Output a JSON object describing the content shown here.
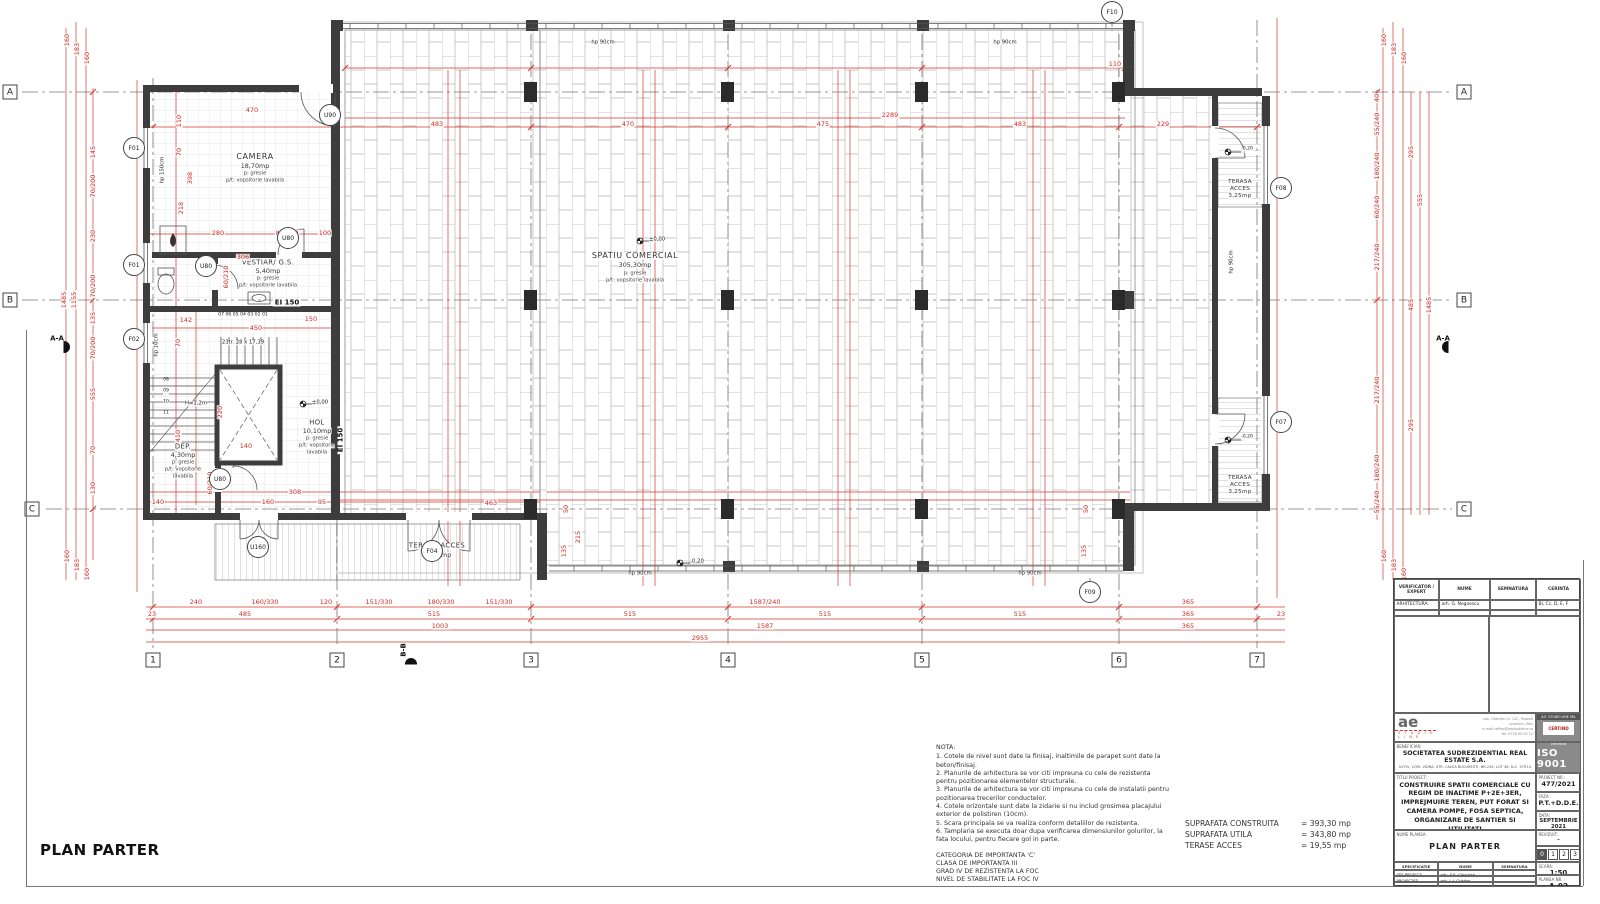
{
  "plan_title": "PLAN PARTER",
  "colors": {
    "dimension_red": "#cf2b24",
    "wall_dark": "#3d3d3d",
    "badge_gray": "#8a8a8a"
  },
  "notes": {
    "title": "NOTA:",
    "lines": [
      "1. Cotele de nivel sunt date la finisaj, inaltimile de parapet sunt date la beton/finisaj.",
      "2. Planurile de arhitectura se vor citi impreuna c​u cele de rezistenta pentru pozitionarea elementelor structurale.",
      "3. Planurile de arhitectura se vor citi impreuna cu cele de instalatii pentru pozitionarea trecerilor conductelor.",
      "4. Cotele orizontale sunt date la zidarie si nu includ grosimea placajului exterior de polistiren (10cm).",
      "5. Scara principala se va realiza conform detaliilor de rezistenta.",
      "6. Tamplaria se executa doar dupa verificarea dimensiunilor golurilor, la fata locului, pentru fiecare gol in parte."
    ],
    "importance": [
      "CATEGORIA DE IMPORTANTA 'C'",
      "CLASA DE IMPORTANTA III",
      "GRAD IV DE REZISTENTA LA FOC",
      "NIVEL DE STABILITATE LA FOC IV"
    ]
  },
  "areas": {
    "rows": [
      {
        "label": "SUPRAFATA CONSTRUITA",
        "value": "= 393,30 mp"
      },
      {
        "label": "SUPRAFATA UTILA",
        "value": "= 343,80 mp"
      },
      {
        "label": "TERASE ACCES",
        "value": "= 19,55 mp"
      }
    ]
  },
  "titleblock": {
    "header": {
      "c1": "VERIFICATOR / EXPERT",
      "c2": "NUME",
      "c3": "SEMNATURA",
      "c4": "CERINTA"
    },
    "arhitectura": {
      "label": "ARHITECTURA:",
      "name": "arh. G. Negoescu",
      "cerinta": "BI, Cc, D, E, F"
    },
    "logo": {
      "mark": "ae",
      "sub": "S T U D I O  L I N E",
      "addr1": "sos. Oltenitei nr. 14C, Popesti",
      "addr2": "Leordeni, Ilfov",
      "addr3": "e-mail: office@aestudioline.ro",
      "addr4": "tel: 0726 90 00 12"
    },
    "badge": {
      "firm": "A.E. STUDIO LINE SRL",
      "cert": "CERTIND",
      "iso_caption": "Sistem de management certificat",
      "iso": "ISO 9001"
    },
    "beneficiar": {
      "label": "BENEFICIAR:",
      "name": "SOCIETATEA SUDREZIDENTIAL REAL ESTATE S.A.",
      "addr": "ILFOV, COM. VIDRA, STR. CALEA BUCURESTI, NR.234, LOT 36, N.C. 57914"
    },
    "titlu": {
      "label": "TITLU PROIECT:",
      "text": "CONSTRUIRE SPATII COMERCIALE CU REGIM DE INALTIME P+2E+3ER, IMPREJMUIRE TEREN, PUT FORAT SI CAMERA POMPE, FOSA SEPTICA, ORGANIZARE DE SANTIER SI UTILITATI"
    },
    "proiect_nr": {
      "label": "PROIECT NR.:",
      "value": "477/2021"
    },
    "faza": {
      "label": "FAZA:",
      "value": "P.T.+D.D.E."
    },
    "data": {
      "label": "DATA:",
      "value": "SEPTEMBRIE 2021"
    },
    "nume_plansa": {
      "label": "NUME PLANSA:",
      "value": "PLAN PARTER"
    },
    "revizuit": {
      "label": "REVIZUIT:",
      "value": "-",
      "boxes": [
        "0",
        "1",
        "2",
        "3"
      ]
    },
    "spec": {
      "c1": "SPECIFICATIE",
      "c2": "NUME",
      "c3": "SEMNATURA"
    },
    "rows": [
      {
        "label": "SEF PROIECT:",
        "name": "arh. A.E. Ciocirlan"
      },
      {
        "label": "PROIECTAT:",
        "name": "arh. L.I. Cristea"
      },
      {
        "label": "VERIFICAT:",
        "name": "arh. A.E. Ciocirlan"
      }
    ],
    "scara": {
      "label": "SCARA:",
      "value": "1:50"
    },
    "plansa_nr": {
      "label": "PLANSA NR. :",
      "value": "A-02"
    }
  },
  "labels": [
    {
      "t": "CAMERA",
      "x": 255,
      "y": 157,
      "c": "rn"
    },
    {
      "t": "18,70mp",
      "x": 255,
      "y": 166,
      "c": "ra"
    },
    {
      "t": "p: gresie",
      "x": 255,
      "y": 174,
      "c": "rf"
    },
    {
      "t": "p/t: vopsitorie lavabila",
      "x": 255,
      "y": 181,
      "c": "rf"
    },
    {
      "t": "VESTIAR/ G.S.",
      "x": 268,
      "y": 263,
      "c": "rn2"
    },
    {
      "t": "5,40mp",
      "x": 268,
      "y": 271,
      "c": "ra"
    },
    {
      "t": "p: gresie",
      "x": 268,
      "y": 279,
      "c": "rf"
    },
    {
      "t": "p/t: vopsitorie lavabila",
      "x": 268,
      "y": 286,
      "c": "rf"
    },
    {
      "t": "SPATIU COMERCIAL",
      "x": 635,
      "y": 256,
      "c": "rn"
    },
    {
      "t": "305,30mp",
      "x": 635,
      "y": 265,
      "c": "ra"
    },
    {
      "t": "p: gresie",
      "x": 635,
      "y": 274,
      "c": "rf"
    },
    {
      "t": "p/t: vopsitorie lavabila",
      "x": 635,
      "y": 281,
      "c": "rf"
    },
    {
      "t": "HOL",
      "x": 317,
      "y": 423,
      "c": "rn2"
    },
    {
      "t": "10,10mp",
      "x": 317,
      "y": 431,
      "c": "ra"
    },
    {
      "t": "p: gresie",
      "x": 317,
      "y": 439,
      "c": "rf"
    },
    {
      "t": "p/t: vopsitorie",
      "x": 317,
      "y": 446,
      "c": "rf"
    },
    {
      "t": "lavabila",
      "x": 317,
      "y": 453,
      "c": "rf"
    },
    {
      "t": "DEP.",
      "x": 183,
      "y": 447,
      "c": "rn2"
    },
    {
      "t": "4,30mp",
      "x": 183,
      "y": 455,
      "c": "ra"
    },
    {
      "t": "p: gresie",
      "x": 183,
      "y": 463,
      "c": "rf"
    },
    {
      "t": "p/t: vopsitorie",
      "x": 183,
      "y": 470,
      "c": "rf"
    },
    {
      "t": "lavabila",
      "x": 183,
      "y": 477,
      "c": "rf"
    },
    {
      "t": "TERASA ACCES",
      "x": 437,
      "y": 546,
      "c": "rn2"
    },
    {
      "t": "13,05mp",
      "x": 437,
      "y": 555,
      "c": "ra"
    },
    {
      "t": "TERASA",
      "x": 1240,
      "y": 183,
      "c": "rn3"
    },
    {
      "t": "ACCES",
      "x": 1240,
      "y": 190,
      "c": "rn3"
    },
    {
      "t": "3,25mp",
      "x": 1240,
      "y": 197,
      "c": "rn3"
    },
    {
      "t": "TERASA",
      "x": 1240,
      "y": 479,
      "c": "rn3"
    },
    {
      "t": "ACCES",
      "x": 1240,
      "y": 486,
      "c": "rn3"
    },
    {
      "t": "3,25mp",
      "x": 1240,
      "y": 493,
      "c": "rn3"
    },
    {
      "t": "EI 150",
      "x": 287,
      "y": 303,
      "c": "ei"
    },
    {
      "t": "EI 150",
      "x": 341,
      "y": 440,
      "c": "ei",
      "r": -90
    },
    {
      "t": "23tr. 28 x 17,39",
      "x": 243,
      "y": 343,
      "c": "bk5"
    },
    {
      "t": "H=1,2m",
      "x": 196,
      "y": 404,
      "c": "bk5"
    },
    {
      "t": "07  06  05  04  03  02  01",
      "x": 243,
      "y": 316,
      "c": "bk4"
    },
    {
      "t": "08",
      "x": 166,
      "y": 381,
      "c": "bk4"
    },
    {
      "t": "09",
      "x": 166,
      "y": 392,
      "c": "bk4"
    },
    {
      "t": "10",
      "x": 166,
      "y": 403,
      "c": "bk4"
    },
    {
      "t": "11",
      "x": 166,
      "y": 414,
      "c": "bk4"
    },
    {
      "t": "hp 150cm",
      "x": 163,
      "y": 170,
      "c": "bk5",
      "r": -90
    },
    {
      "t": "hp 10cm",
      "x": 157,
      "y": 345,
      "c": "bk5",
      "r": -90
    },
    {
      "t": "hp 90cm",
      "x": 1232,
      "y": 262,
      "c": "bk5",
      "r": -90
    },
    {
      "t": "hp 90cm",
      "x": 603,
      "y": 43,
      "c": "bk5"
    },
    {
      "t": "hp 90cm",
      "x": 1005,
      "y": 43,
      "c": "bk5"
    },
    {
      "t": "hp 90cm",
      "x": 640,
      "y": 574,
      "c": "bk5"
    },
    {
      "t": "hp 90cm",
      "x": 1030,
      "y": 574,
      "c": "bk5"
    },
    {
      "t": "±0,00",
      "x": 657,
      "y": 240,
      "c": "bk5"
    },
    {
      "t": "±0,00",
      "x": 320,
      "y": 403,
      "c": "bk5"
    },
    {
      "t": "-0,20",
      "x": 697,
      "y": 562,
      "c": "bk5"
    },
    {
      "t": "-0,20",
      "x": 1247,
      "y": 150,
      "c": "bk4"
    },
    {
      "t": "-0,20",
      "x": 1247,
      "y": 438,
      "c": "bk4"
    },
    {
      "t": "470",
      "x": 252,
      "y": 110,
      "c": "dim"
    },
    {
      "t": "110",
      "x": 179,
      "y": 121,
      "c": "dim",
      "r": -90
    },
    {
      "t": "70",
      "x": 179,
      "y": 152,
      "c": "dim",
      "r": -90
    },
    {
      "t": "398",
      "x": 190,
      "y": 178,
      "c": "dim",
      "r": -90
    },
    {
      "t": "218",
      "x": 181,
      "y": 208,
      "c": "dim",
      "r": -90
    },
    {
      "t": "280",
      "x": 218,
      "y": 233,
      "c": "dim"
    },
    {
      "t": "80/210",
      "x": 287,
      "y": 233,
      "c": "dim"
    },
    {
      "t": "100",
      "x": 325,
      "y": 233,
      "c": "dim"
    },
    {
      "t": "306",
      "x": 243,
      "y": 257,
      "c": "dim"
    },
    {
      "t": "60/210",
      "x": 226,
      "y": 277,
      "c": "dim",
      "r": -90
    },
    {
      "t": "142",
      "x": 186,
      "y": 320,
      "c": "dim"
    },
    {
      "t": "450",
      "x": 256,
      "y": 328,
      "c": "dim"
    },
    {
      "t": "150",
      "x": 311,
      "y": 319,
      "c": "dim"
    },
    {
      "t": "70",
      "x": 178,
      "y": 343,
      "c": "dim",
      "r": -90
    },
    {
      "t": "410",
      "x": 178,
      "y": 436,
      "c": "dim",
      "r": -90
    },
    {
      "t": "220",
      "x": 220,
      "y": 412,
      "c": "dim",
      "r": -90
    },
    {
      "t": "140",
      "x": 246,
      "y": 446,
      "c": "dim"
    },
    {
      "t": "308",
      "x": 295,
      "y": 492,
      "c": "dim"
    },
    {
      "t": "160",
      "x": 268,
      "y": 502,
      "c": "dim"
    },
    {
      "t": "95",
      "x": 322,
      "y": 502,
      "c": "dim"
    },
    {
      "t": "140",
      "x": 158,
      "y": 502,
      "c": "dim"
    },
    {
      "t": "60/210",
      "x": 210,
      "y": 483,
      "c": "dim",
      "r": -90
    },
    {
      "t": "463",
      "x": 491,
      "y": 503,
      "c": "dim"
    },
    {
      "t": "483",
      "x": 437,
      "y": 124,
      "c": "dim"
    },
    {
      "t": "470",
      "x": 628,
      "y": 124,
      "c": "dim"
    },
    {
      "t": "475",
      "x": 823,
      "y": 124,
      "c": "dim"
    },
    {
      "t": "483",
      "x": 1020,
      "y": 124,
      "c": "dim"
    },
    {
      "t": "229",
      "x": 1163,
      "y": 124,
      "c": "dim"
    },
    {
      "t": "2289",
      "x": 890,
      "y": 115,
      "c": "dim"
    },
    {
      "t": "110",
      "x": 1115,
      "y": 64,
      "c": "dim"
    },
    {
      "t": "160",
      "x": 67,
      "y": 40,
      "c": "dim",
      "r": -90
    },
    {
      "t": "183",
      "x": 77,
      "y": 49,
      "c": "dim",
      "r": -90
    },
    {
      "t": "160",
      "x": 87,
      "y": 58,
      "c": "dim",
      "r": -90
    },
    {
      "t": "145",
      "x": 93,
      "y": 152,
      "c": "dim",
      "r": -90
    },
    {
      "t": "70/200",
      "x": 93,
      "y": 186,
      "c": "dim",
      "r": -90
    },
    {
      "t": "230",
      "x": 93,
      "y": 236,
      "c": "dim",
      "r": -90
    },
    {
      "t": "70/200",
      "x": 93,
      "y": 286,
      "c": "dim",
      "r": -90
    },
    {
      "t": "135",
      "x": 93,
      "y": 318,
      "c": "dim",
      "r": -90
    },
    {
      "t": "70/200",
      "x": 93,
      "y": 348,
      "c": "dim",
      "r": -90
    },
    {
      "t": "555",
      "x": 93,
      "y": 394,
      "c": "dim",
      "r": -90
    },
    {
      "t": "70",
      "x": 93,
      "y": 450,
      "c": "dim",
      "r": -90
    },
    {
      "t": "130",
      "x": 93,
      "y": 488,
      "c": "dim",
      "r": -90
    },
    {
      "t": "1485",
      "x": 64,
      "y": 300,
      "c": "dim",
      "r": -90
    },
    {
      "t": "1155",
      "x": 74,
      "y": 300,
      "c": "dim",
      "r": -90
    },
    {
      "t": "160",
      "x": 67,
      "y": 556,
      "c": "dim",
      "r": -90
    },
    {
      "t": "183",
      "x": 77,
      "y": 565,
      "c": "dim",
      "r": -90
    },
    {
      "t": "160",
      "x": 87,
      "y": 574,
      "c": "dim",
      "r": -90
    },
    {
      "t": "160",
      "x": 1384,
      "y": 40,
      "c": "dim",
      "r": -90
    },
    {
      "t": "183",
      "x": 1394,
      "y": 49,
      "c": "dim",
      "r": -90
    },
    {
      "t": "160",
      "x": 1404,
      "y": 58,
      "c": "dim",
      "r": -90
    },
    {
      "t": "40",
      "x": 1377,
      "y": 98,
      "c": "dim",
      "r": -90
    },
    {
      "t": "55/240",
      "x": 1377,
      "y": 124,
      "c": "dim",
      "r": -90
    },
    {
      "t": "180/240",
      "x": 1377,
      "y": 166,
      "c": "dim",
      "r": -90
    },
    {
      "t": "60/240",
      "x": 1377,
      "y": 207,
      "c": "dim",
      "r": -90
    },
    {
      "t": "217/240",
      "x": 1377,
      "y": 257,
      "c": "dim",
      "r": -90
    },
    {
      "t": "295",
      "x": 1411,
      "y": 152,
      "c": "dim",
      "r": -90
    },
    {
      "t": "555",
      "x": 1420,
      "y": 200,
      "c": "dim",
      "r": -90
    },
    {
      "t": "485",
      "x": 1411,
      "y": 305,
      "c": "dim",
      "r": -90
    },
    {
      "t": "1485",
      "x": 1429,
      "y": 305,
      "c": "dim",
      "r": -90
    },
    {
      "t": "217/240",
      "x": 1377,
      "y": 390,
      "c": "dim",
      "r": -90
    },
    {
      "t": "295",
      "x": 1411,
      "y": 425,
      "c": "dim",
      "r": -90
    },
    {
      "t": "180/240",
      "x": 1377,
      "y": 468,
      "c": "dim",
      "r": -90
    },
    {
      "t": "55/240",
      "x": 1377,
      "y": 502,
      "c": "dim",
      "r": -90
    },
    {
      "t": "160",
      "x": 1384,
      "y": 556,
      "c": "dim",
      "r": -90
    },
    {
      "t": "183",
      "x": 1394,
      "y": 565,
      "c": "dim",
      "r": -90
    },
    {
      "t": "160",
      "x": 1404,
      "y": 574,
      "c": "dim",
      "r": -90
    },
    {
      "t": "240",
      "x": 196,
      "y": 602,
      "c": "dim"
    },
    {
      "t": "160/330",
      "x": 265,
      "y": 602,
      "c": "dim"
    },
    {
      "t": "120",
      "x": 326,
      "y": 602,
      "c": "dim"
    },
    {
      "t": "151/330",
      "x": 379,
      "y": 602,
      "c": "dim"
    },
    {
      "t": "180/330",
      "x": 441,
      "y": 602,
      "c": "dim"
    },
    {
      "t": "151/330",
      "x": 499,
      "y": 602,
      "c": "dim"
    },
    {
      "t": "1587/240",
      "x": 765,
      "y": 602,
      "c": "dim"
    },
    {
      "t": "365",
      "x": 1188,
      "y": 602,
      "c": "dim"
    },
    {
      "t": "23",
      "x": 152,
      "y": 614,
      "c": "dim"
    },
    {
      "t": "485",
      "x": 245,
      "y": 614,
      "c": "dim"
    },
    {
      "t": "515",
      "x": 434,
      "y": 614,
      "c": "dim"
    },
    {
      "t": "515",
      "x": 630,
      "y": 614,
      "c": "dim"
    },
    {
      "t": "515",
      "x": 825,
      "y": 614,
      "c": "dim"
    },
    {
      "t": "515",
      "x": 1020,
      "y": 614,
      "c": "dim"
    },
    {
      "t": "365",
      "x": 1188,
      "y": 614,
      "c": "dim"
    },
    {
      "t": "23",
      "x": 1281,
      "y": 614,
      "c": "dim"
    },
    {
      "t": "1003",
      "x": 440,
      "y": 626,
      "c": "dim"
    },
    {
      "t": "1587",
      "x": 765,
      "y": 626,
      "c": "dim"
    },
    {
      "t": "365",
      "x": 1188,
      "y": 626,
      "c": "dim"
    },
    {
      "t": "2955",
      "x": 700,
      "y": 638,
      "c": "dim"
    },
    {
      "t": "50",
      "x": 566,
      "y": 509,
      "c": "dim",
      "r": -90
    },
    {
      "t": "215",
      "x": 578,
      "y": 537,
      "c": "dim",
      "r": -90
    },
    {
      "t": "135",
      "x": 564,
      "y": 551,
      "c": "dim",
      "r": -90
    },
    {
      "t": "50",
      "x": 1086,
      "y": 509,
      "c": "dim",
      "r": -90
    },
    {
      "t": "135",
      "x": 1084,
      "y": 551,
      "c": "dim",
      "r": -90
    },
    {
      "t": "A-A",
      "x": 57,
      "y": 339,
      "c": "sec"
    },
    {
      "t": "A-A",
      "x": 1443,
      "y": 339,
      "c": "sec"
    },
    {
      "t": "B-B",
      "x": 404,
      "y": 650,
      "c": "sec",
      "r": -90
    }
  ],
  "tags": [
    {
      "t": "A",
      "x": 10,
      "y": 92,
      "s": "q"
    },
    {
      "t": "B",
      "x": 10,
      "y": 300,
      "s": "q"
    },
    {
      "t": "C",
      "x": 32,
      "y": 509,
      "s": "q"
    },
    {
      "t": "A",
      "x": 1464,
      "y": 92,
      "s": "q"
    },
    {
      "t": "B",
      "x": 1464,
      "y": 300,
      "s": "q"
    },
    {
      "t": "C",
      "x": 1464,
      "y": 509,
      "s": "q"
    },
    {
      "t": "1",
      "x": 153,
      "y": 660,
      "s": "q"
    },
    {
      "t": "2",
      "x": 337,
      "y": 660,
      "s": "q"
    },
    {
      "t": "3",
      "x": 531,
      "y": 660,
      "s": "q"
    },
    {
      "t": "4",
      "x": 728,
      "y": 660,
      "s": "q"
    },
    {
      "t": "5",
      "x": 922,
      "y": 660,
      "s": "q"
    },
    {
      "t": "6",
      "x": 1119,
      "y": 660,
      "s": "q"
    },
    {
      "t": "7",
      "x": 1257,
      "y": 660,
      "s": "q"
    },
    {
      "t": "F01",
      "x": 134,
      "y": 148,
      "s": "c"
    },
    {
      "t": "F01",
      "x": 134,
      "y": 265,
      "s": "c"
    },
    {
      "t": "F02",
      "x": 134,
      "y": 339,
      "s": "c"
    },
    {
      "t": "U90",
      "x": 330,
      "y": 115,
      "s": "c"
    },
    {
      "t": "U80",
      "x": 288,
      "y": 238,
      "s": "c"
    },
    {
      "t": "U80",
      "x": 206,
      "y": 266,
      "s": "c"
    },
    {
      "t": "U80",
      "x": 220,
      "y": 479,
      "s": "c"
    },
    {
      "t": "U160",
      "x": 258,
      "y": 547,
      "s": "c"
    },
    {
      "t": "F04",
      "x": 432,
      "y": 551,
      "s": "c"
    },
    {
      "t": "F07",
      "x": 1281,
      "y": 422,
      "s": "c"
    },
    {
      "t": "F08",
      "x": 1281,
      "y": 188,
      "s": "c"
    },
    {
      "t": "F09",
      "x": 1090,
      "y": 592,
      "s": "c"
    },
    {
      "t": "F10",
      "x": 1112,
      "y": 12,
      "s": "c"
    }
  ]
}
